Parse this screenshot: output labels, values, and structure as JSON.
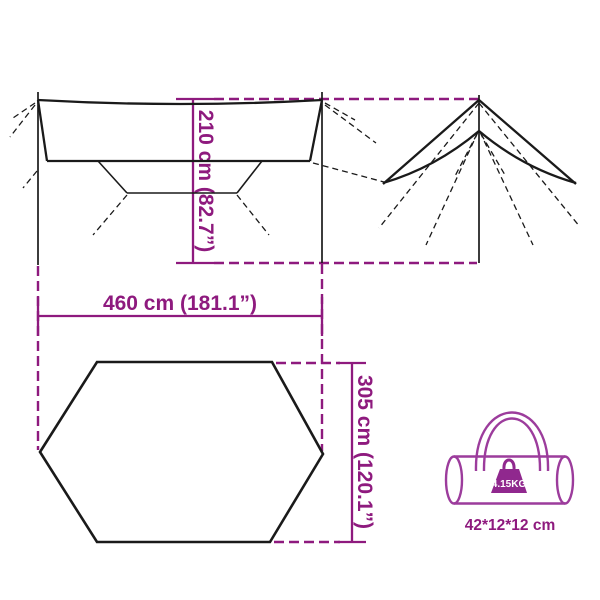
{
  "page": {
    "background": "#FFFFFF"
  },
  "colors": {
    "accent_magenta": "#8E1A7E",
    "line_black": "#1A1A1A",
    "bag_outline": "#9C3C9C",
    "weight_fill": "#90288E",
    "weight_text": "#FFFFFF"
  },
  "measurements": {
    "width": "460 cm (181.1”)",
    "height": "210 cm (82.7”)",
    "depth": "305 cm (120.1”)"
  },
  "bag": {
    "weight": "4.15KG",
    "packed_size": "42*12*12 cm"
  }
}
